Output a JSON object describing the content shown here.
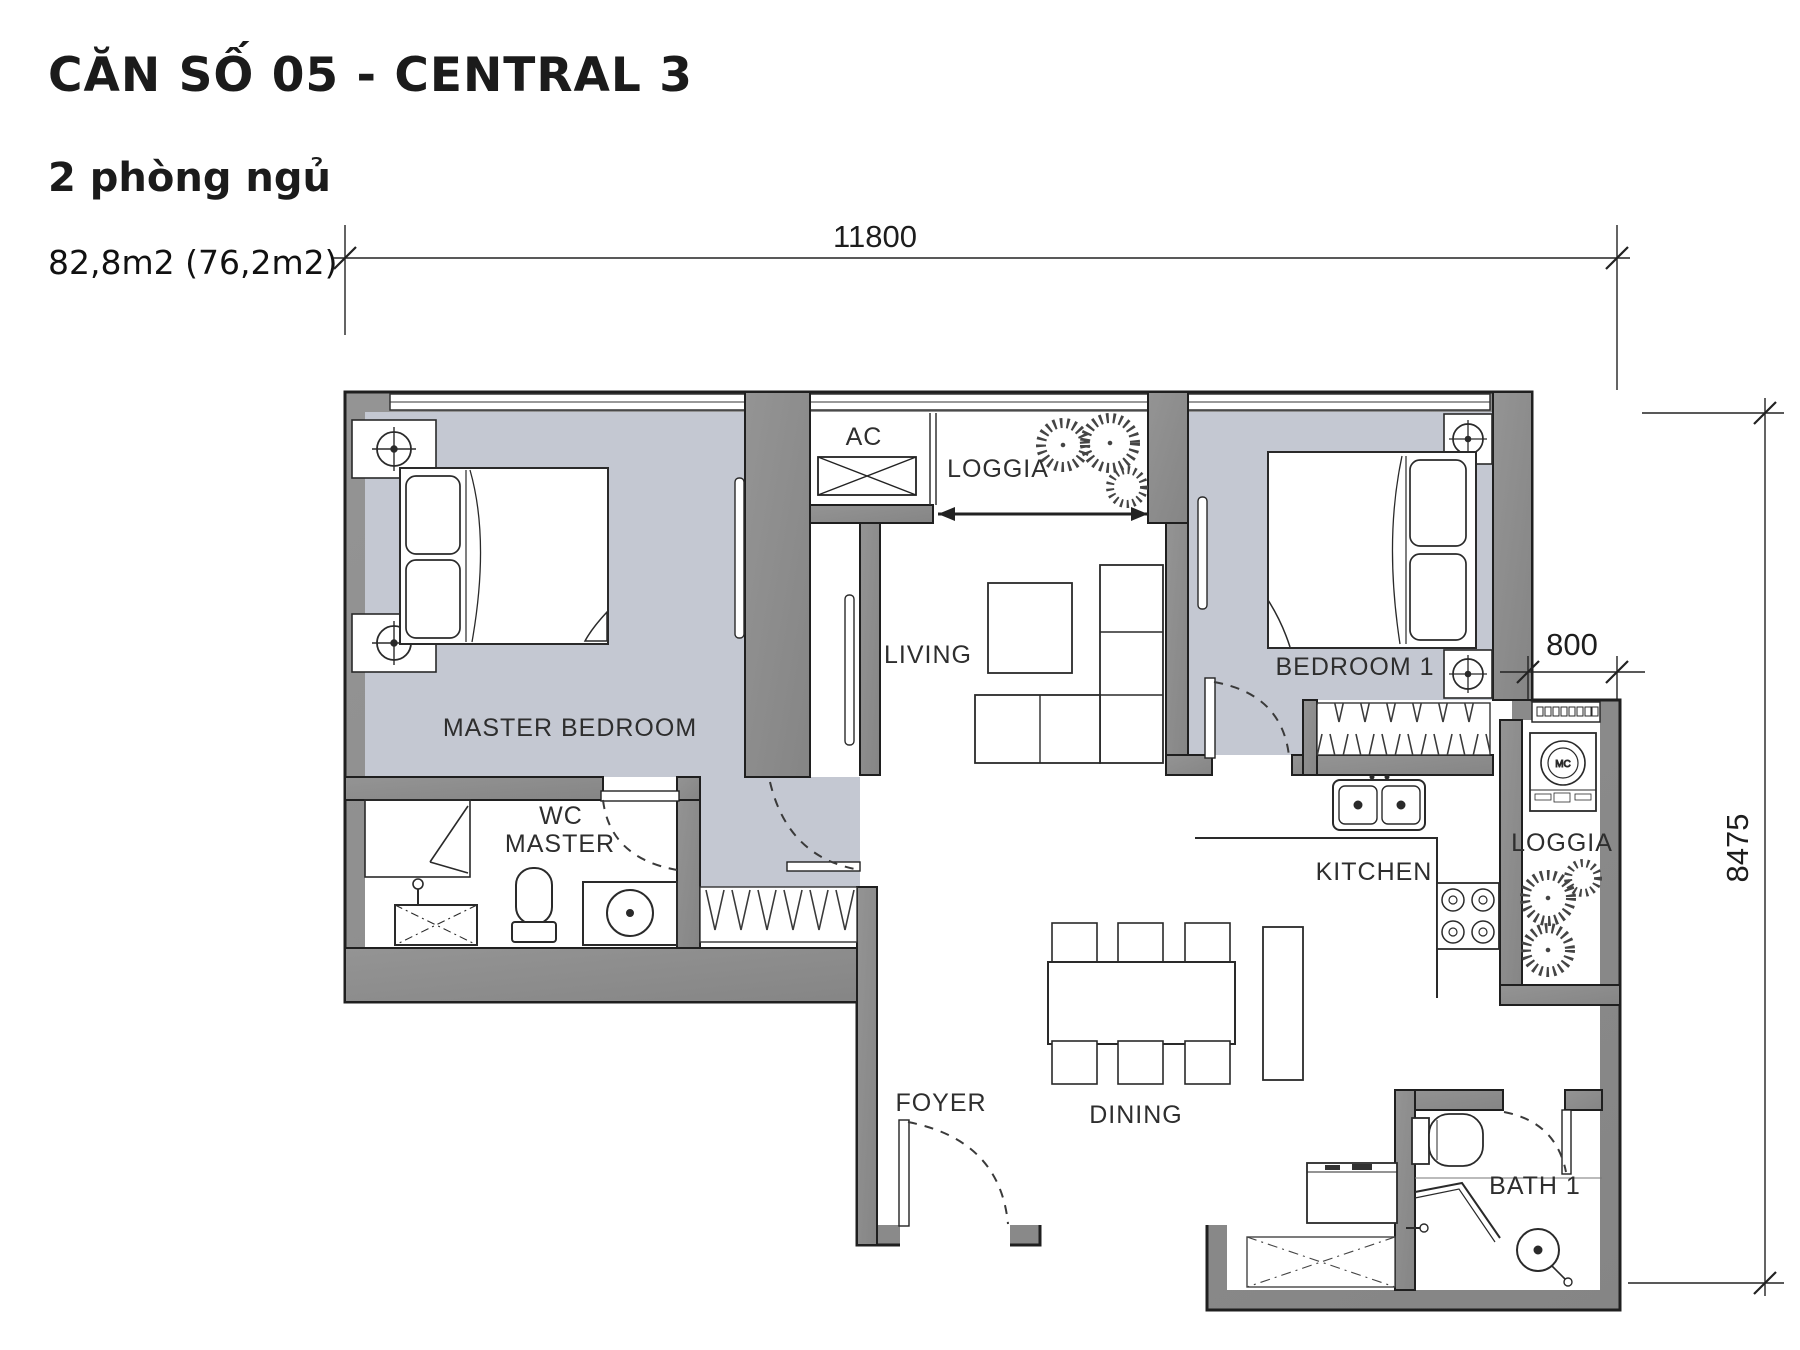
{
  "header": {
    "title": "CĂN SỐ 05 - CENTRAL 3",
    "subtitle": "2 phòng ngủ",
    "area": "82,8m2 (76,2m2)"
  },
  "rooms": {
    "master_bedroom": "MASTER BEDROOM",
    "wc_master_l1": "WC",
    "wc_master_l2": "MASTER",
    "living": "LIVING",
    "ac": "AC",
    "loggia_top": "LOGGIA",
    "bedroom1": "BEDROOM 1",
    "kitchen": "KITCHEN",
    "loggia_right": "LOGGIA",
    "dining": "DINING",
    "foyer": "FOYER",
    "bath1": "BATH 1"
  },
  "dimensions": {
    "total_width": "11800",
    "loggia_width": "800",
    "total_height": "8475"
  },
  "appliances": {
    "washing_machine": "MC"
  },
  "colors": {
    "wall": "#8c8c8c",
    "floor": "#c4c8d2",
    "line": "#222222"
  }
}
